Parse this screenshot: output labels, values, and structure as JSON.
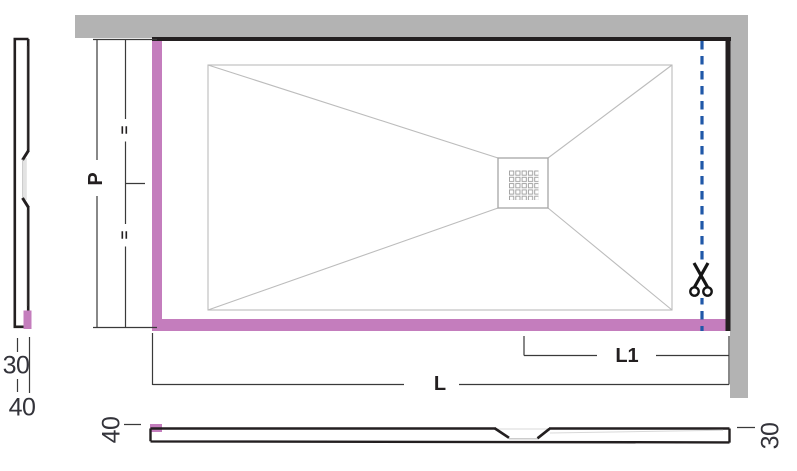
{
  "meta": {
    "description": "Shower tray cut-to-size installation diagram"
  },
  "colors": {
    "wall": "#b3b3b3",
    "trim": "#c47dbd",
    "outline": "#231f20",
    "cut_line": "#2058a8",
    "scissors": "#151515"
  },
  "labels": {
    "depth": "P",
    "equal_upper": "=",
    "equal_lower": "=",
    "length": "L",
    "cut_length": "L1",
    "left_profile_thickness": "30",
    "left_profile_height": "40",
    "bottom_profile_left_height": "40",
    "bottom_profile_right_height": "30"
  }
}
